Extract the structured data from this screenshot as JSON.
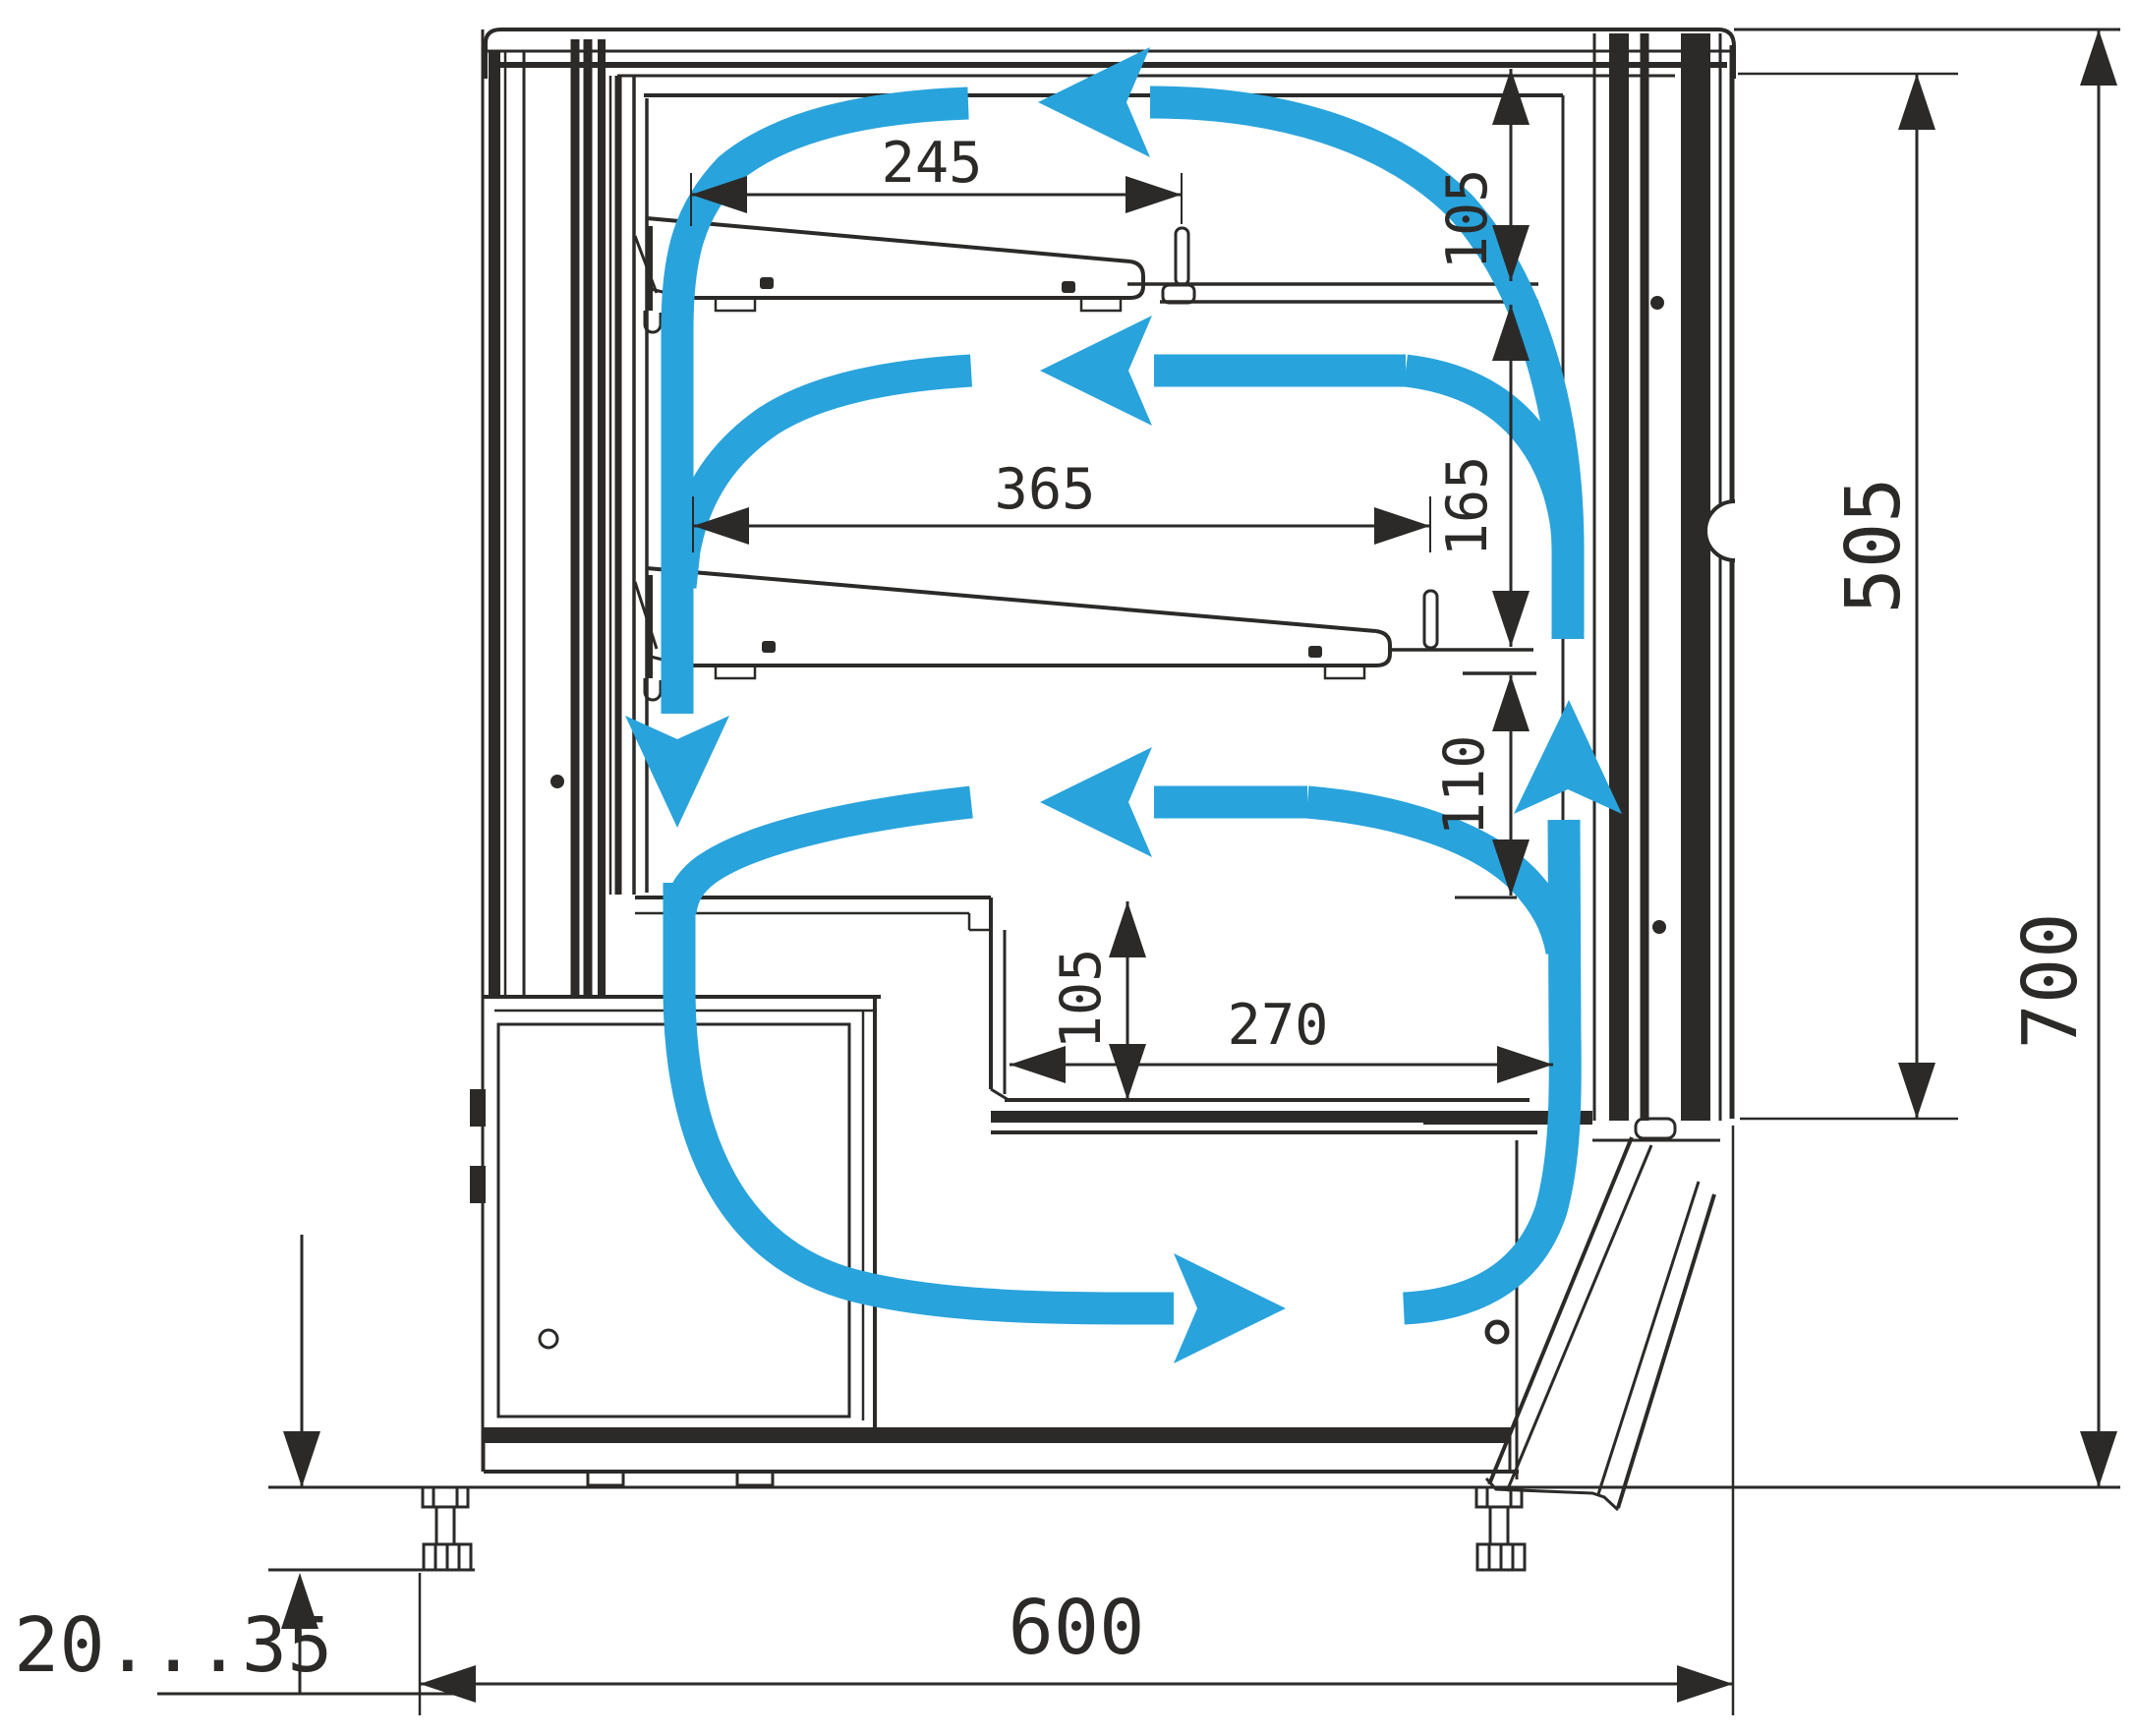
{
  "meta": {
    "type": "technical-drawing",
    "subject": "refrigerated display case side cross-section with air circulation",
    "units": "mm"
  },
  "colors": {
    "line": "#2b2a28",
    "airflow": "#29a3dc",
    "background": "#ffffff"
  },
  "dims": {
    "shelf1_depth": "245",
    "shelf1_headroom": "105",
    "shelf2_depth": "365",
    "between_shelves": "165",
    "under_shelf2": "110",
    "well_headroom": "105",
    "well_depth": "270",
    "glass_height": "505",
    "overall_height": "700",
    "overall_depth": "600",
    "feet_adjust_range": "20...35"
  },
  "airflow": {
    "color": "#29a3dc",
    "pattern": "closed circulation loop: down the rear duct, right along the bottom duct, up the front glass, left across each display level",
    "arrows": [
      {
        "name": "top-return",
        "direction": "left"
      },
      {
        "name": "rear-downflow",
        "direction": "down"
      },
      {
        "name": "mid-return",
        "direction": "left"
      },
      {
        "name": "lower-return",
        "direction": "left"
      },
      {
        "name": "bottom-duct",
        "direction": "right"
      },
      {
        "name": "front-riser",
        "direction": "up"
      }
    ]
  }
}
